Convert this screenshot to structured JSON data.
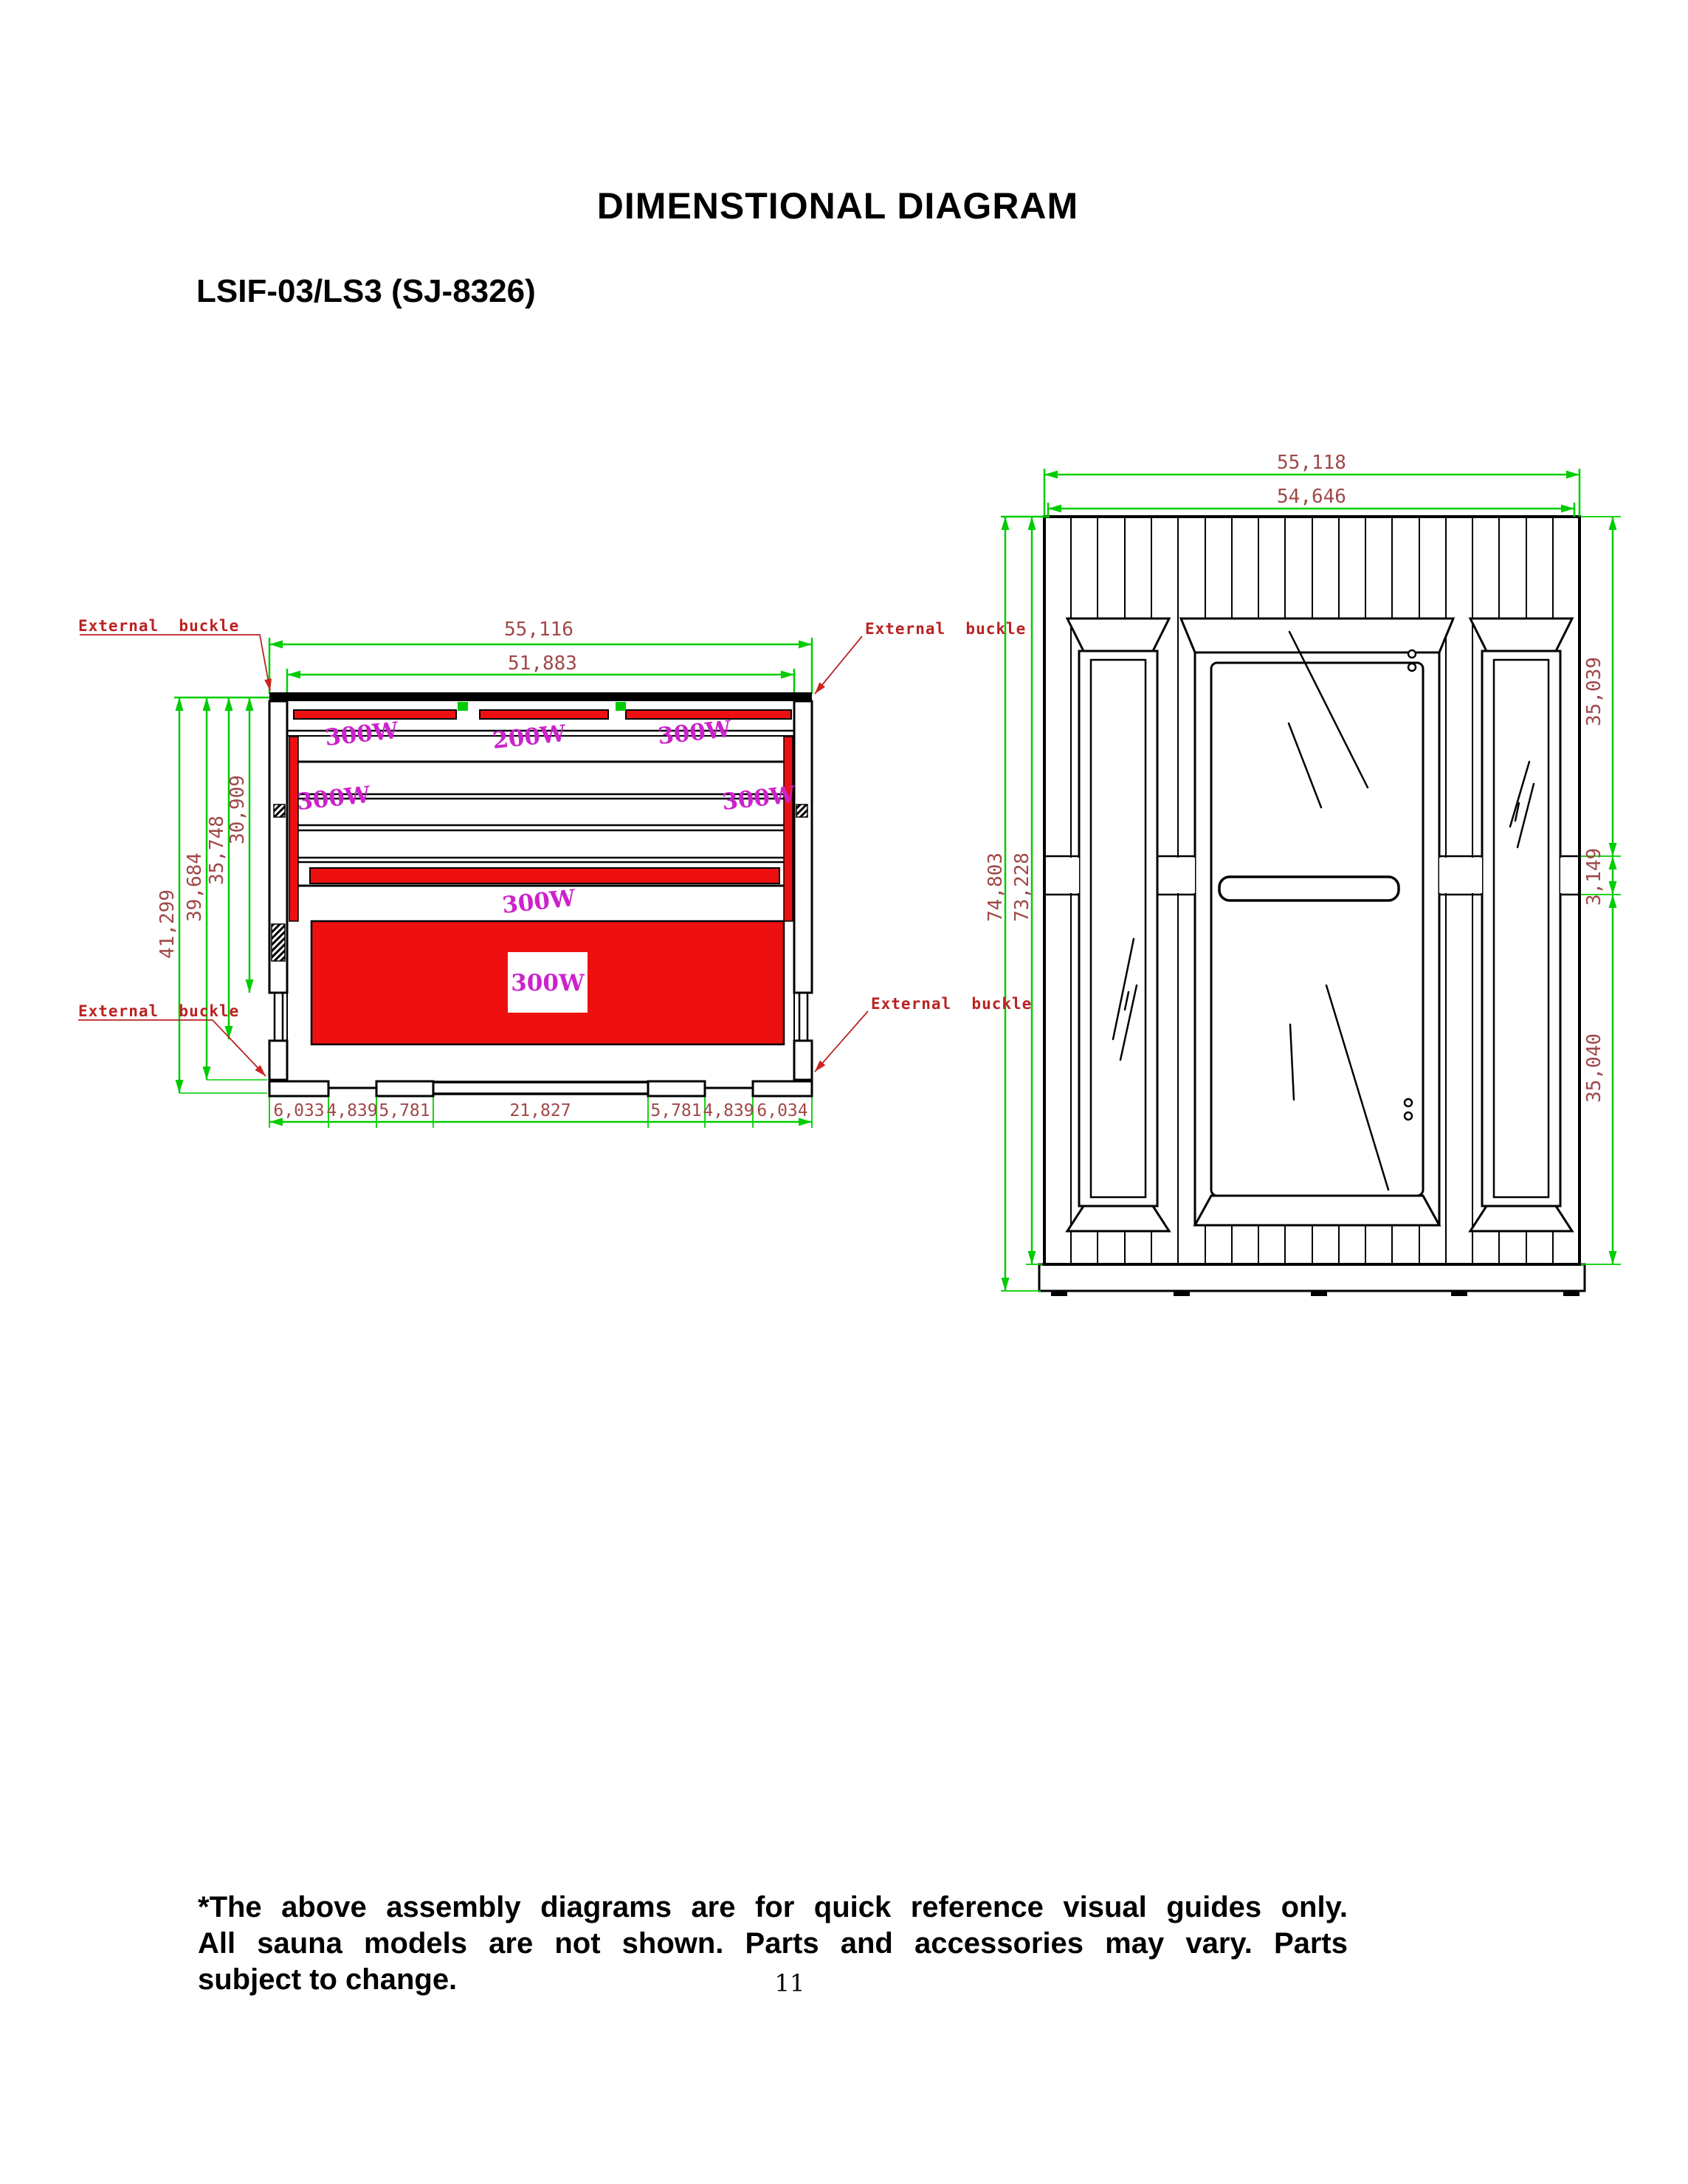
{
  "title": "DIMENSTIONAL DIAGRAM",
  "model": "LSIF-03/LS3 (SJ-8326)",
  "page_number": "11",
  "footer": {
    "line1": "*The above assembly diagrams are for quick reference visual guides only.",
    "line2": "All sauna models are not shown.  Parts and accessories may vary.  Parts",
    "line3": "subject to change."
  },
  "front_view": {
    "label_external_buckle": "External  buckle",
    "dim_width_outer": "55,116",
    "dim_width_inner": "51,883",
    "dims_height": [
      "41,299",
      "39,684",
      "35,748",
      "30,909"
    ],
    "dims_bottom": [
      "6,033",
      "4,839",
      "5,781",
      "21,827",
      "5,781",
      "4,839",
      "6,034"
    ],
    "heater_top": [
      "300W",
      "200W",
      "300W"
    ],
    "heater_left": "300W",
    "heater_right": "300W",
    "heater_middle": "300W",
    "heater_bottom": "300W"
  },
  "panel_view": {
    "dim_width_outer": "55,118",
    "dim_width_inner": "54,646",
    "dim_height_outer": "74,803",
    "dim_height_inner": "73,228",
    "dims_right": [
      "35,039",
      "3,149",
      "35,040"
    ]
  },
  "colors": {
    "dimension_line": "#00cc00",
    "dimension_text": "#a04848",
    "annotation_red": "#bb2222",
    "heater_label": "#cc22cc",
    "heater_fill": "#ee1010",
    "drawing_line": "#000000"
  }
}
